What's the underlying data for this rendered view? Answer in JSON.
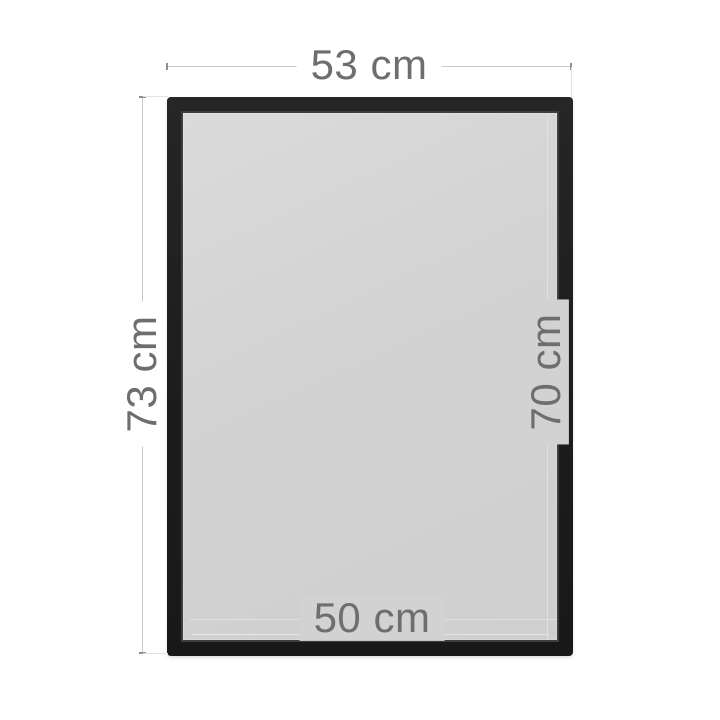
{
  "diagram": {
    "subject": "picture-frame-dimension-diagram",
    "labels": {
      "outer_width": "53 cm",
      "outer_height": "73 cm",
      "inner_height": "70 cm",
      "inner_width": "50 cm"
    },
    "measurements": {
      "outer_width_cm": 53,
      "outer_height_cm": 73,
      "inner_height_cm": 70,
      "inner_width_cm": 50,
      "unit": "cm"
    },
    "colors": {
      "background": "#ffffff",
      "frame": "#1e1e1e",
      "frame_bevel": "#3e3e3e",
      "glass": "#d0d0d0",
      "text": "#6e6e6e",
      "line_outer": "#c9c9c9",
      "line_inner": "#e0e0e0",
      "tick": "#8f8f8f"
    }
  }
}
